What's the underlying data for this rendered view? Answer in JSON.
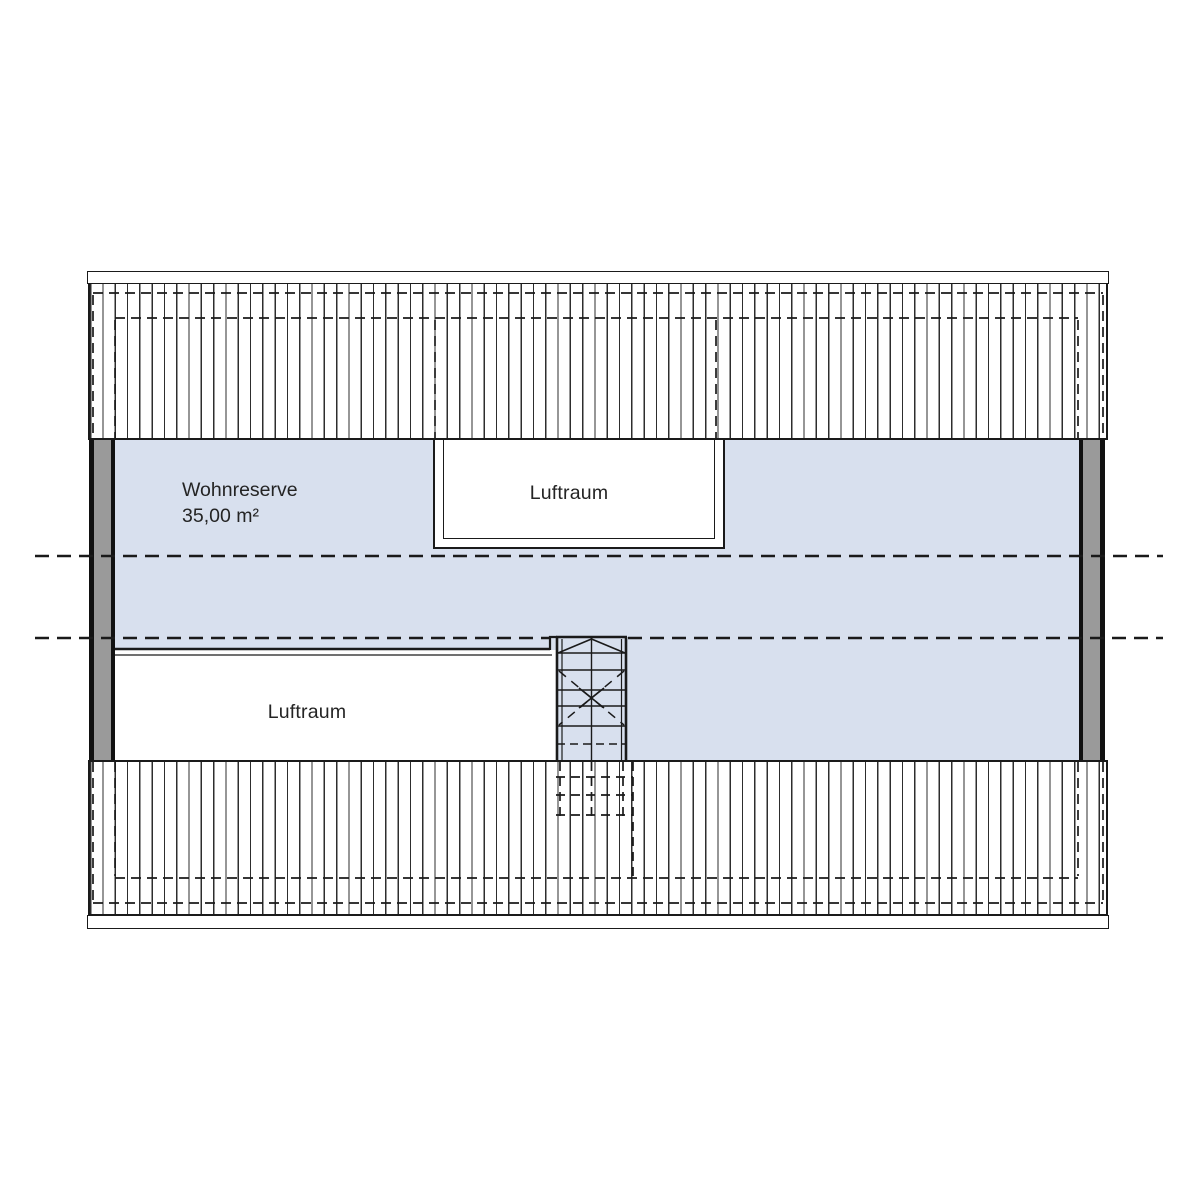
{
  "plan": {
    "rooms": {
      "wohnreserve": {
        "label": "Wohnreserve",
        "area": "35,00 m²"
      },
      "luftraum_top": {
        "label": "Luftraum"
      },
      "luftraum_bottom": {
        "label": "Luftraum"
      }
    }
  },
  "colors": {
    "room-fill": "#d8e0ee",
    "wall-fill": "#9a9a9a",
    "line-color": "#1a1a1a",
    "bg": "#ffffff",
    "text-color": "#242424"
  }
}
